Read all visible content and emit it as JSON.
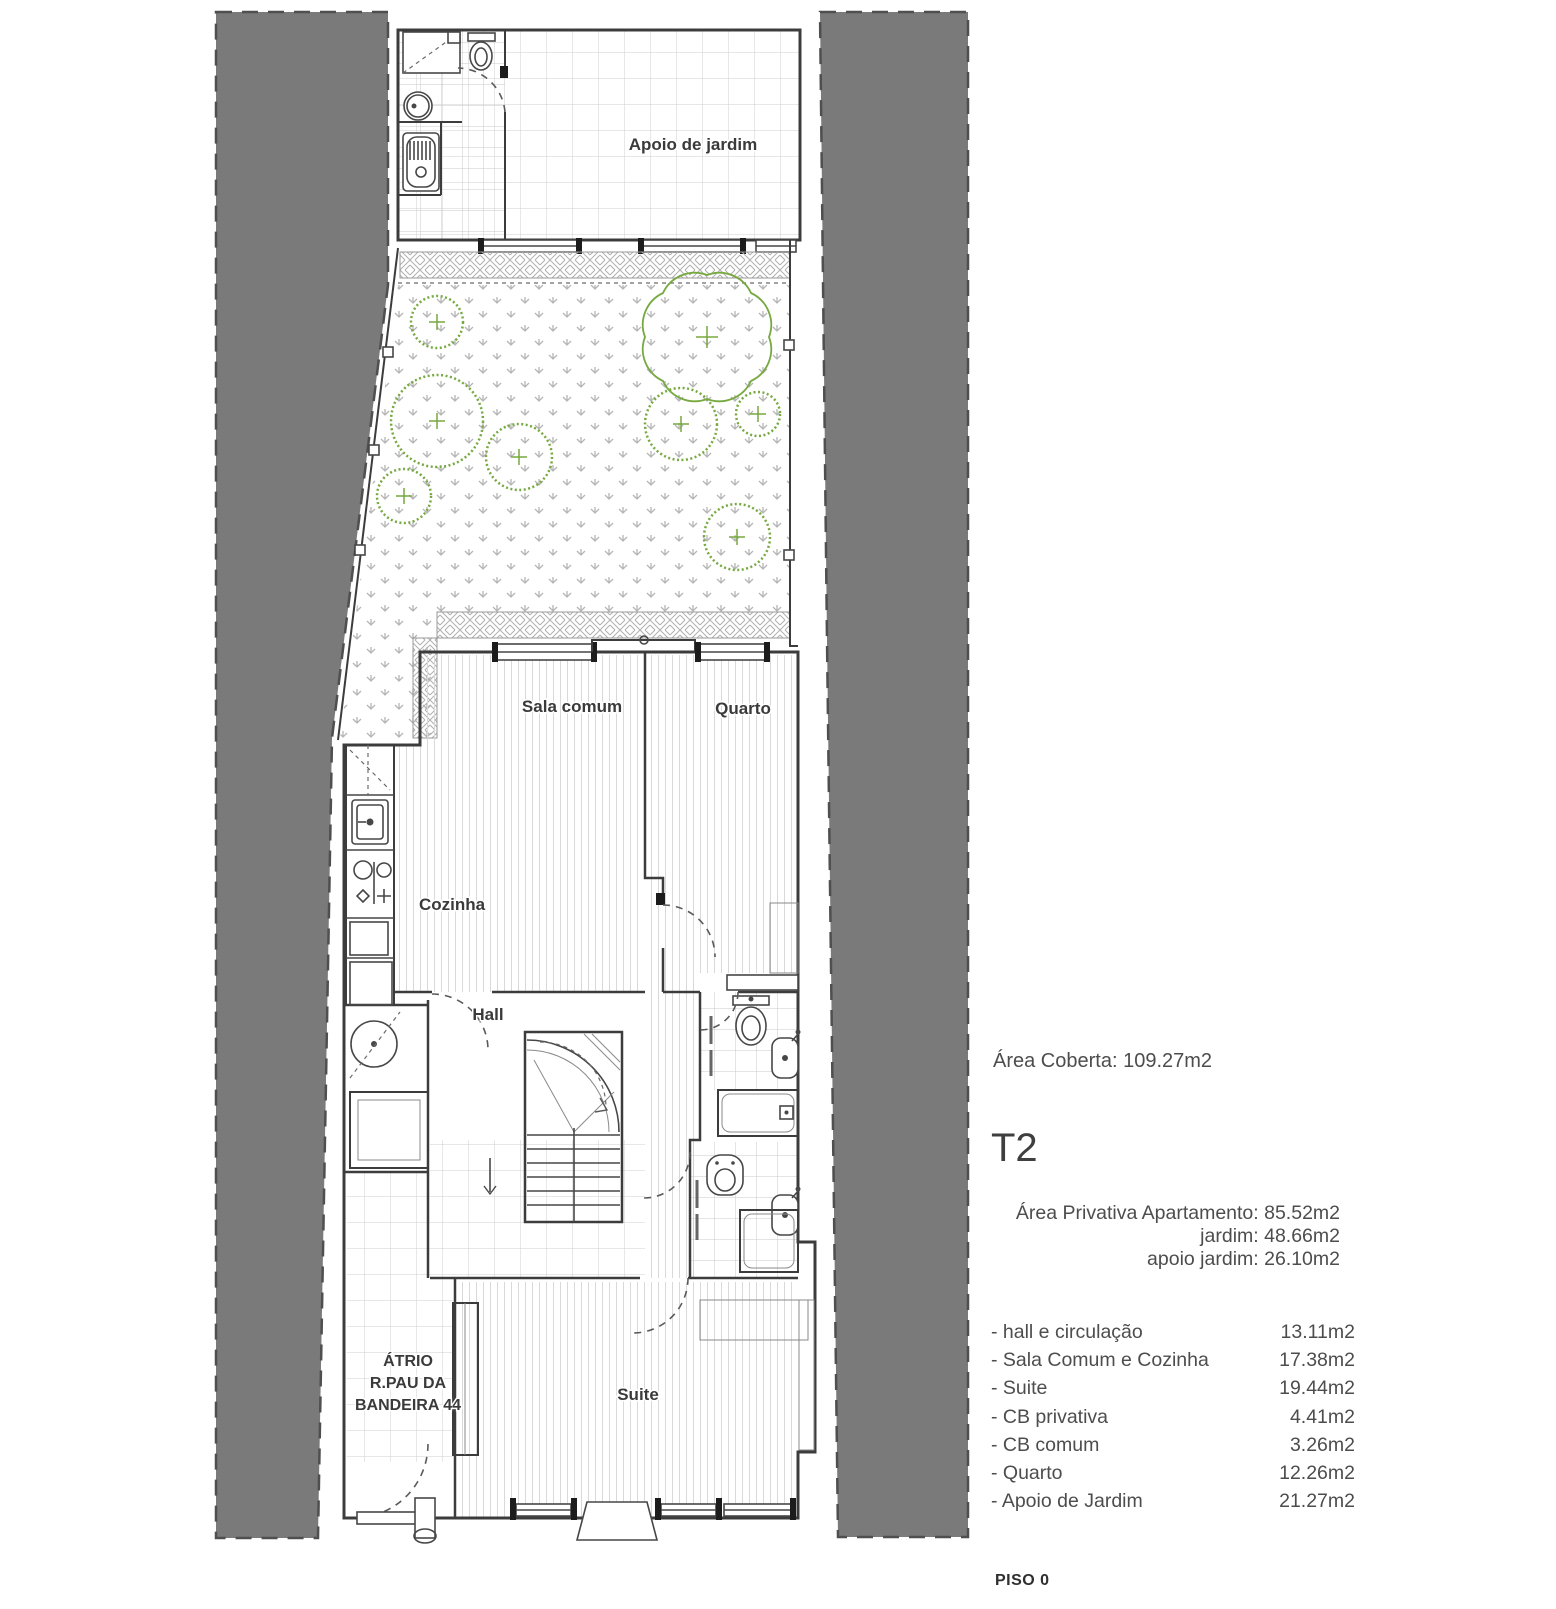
{
  "plan": {
    "labels": {
      "apoio": "Apoio de jardim",
      "sala": "Sala comum",
      "quarto": "Quarto",
      "cozinha": "Cozinha",
      "hall": "Hall",
      "suite": "Suite",
      "atrio_line1": "ÁTRIO",
      "atrio_line2": "R.PAU DA",
      "atrio_line3": "BANDEIRA 44"
    },
    "floor_label": "PISO 0"
  },
  "summary": {
    "area_coberta": "Área Coberta: 109.27m2",
    "unit_type": "T2",
    "private_areas": [
      "Área Privativa Apartamento: 85.52m2",
      "jardim: 48.66m2",
      "apoio jardim: 26.10m2"
    ],
    "rooms": [
      {
        "label": "- hall e circulação",
        "area": "13.11m2"
      },
      {
        "label": "- Sala Comum e Cozinha",
        "area": "17.38m2"
      },
      {
        "label": "- Suite",
        "area": "19.44m2"
      },
      {
        "label": "- CB privativa",
        "area": "4.41m2"
      },
      {
        "label": "- CB comum",
        "area": "3.26m2"
      },
      {
        "label": "- Quarto",
        "area": "12.26m2"
      },
      {
        "label": "- Apoio de Jardim",
        "area": "21.27m2"
      }
    ]
  },
  "colors": {
    "neighbor_grey": "#7a7a7a",
    "wall": "#3c3c3c",
    "vegetation_green": "#76a93f"
  }
}
